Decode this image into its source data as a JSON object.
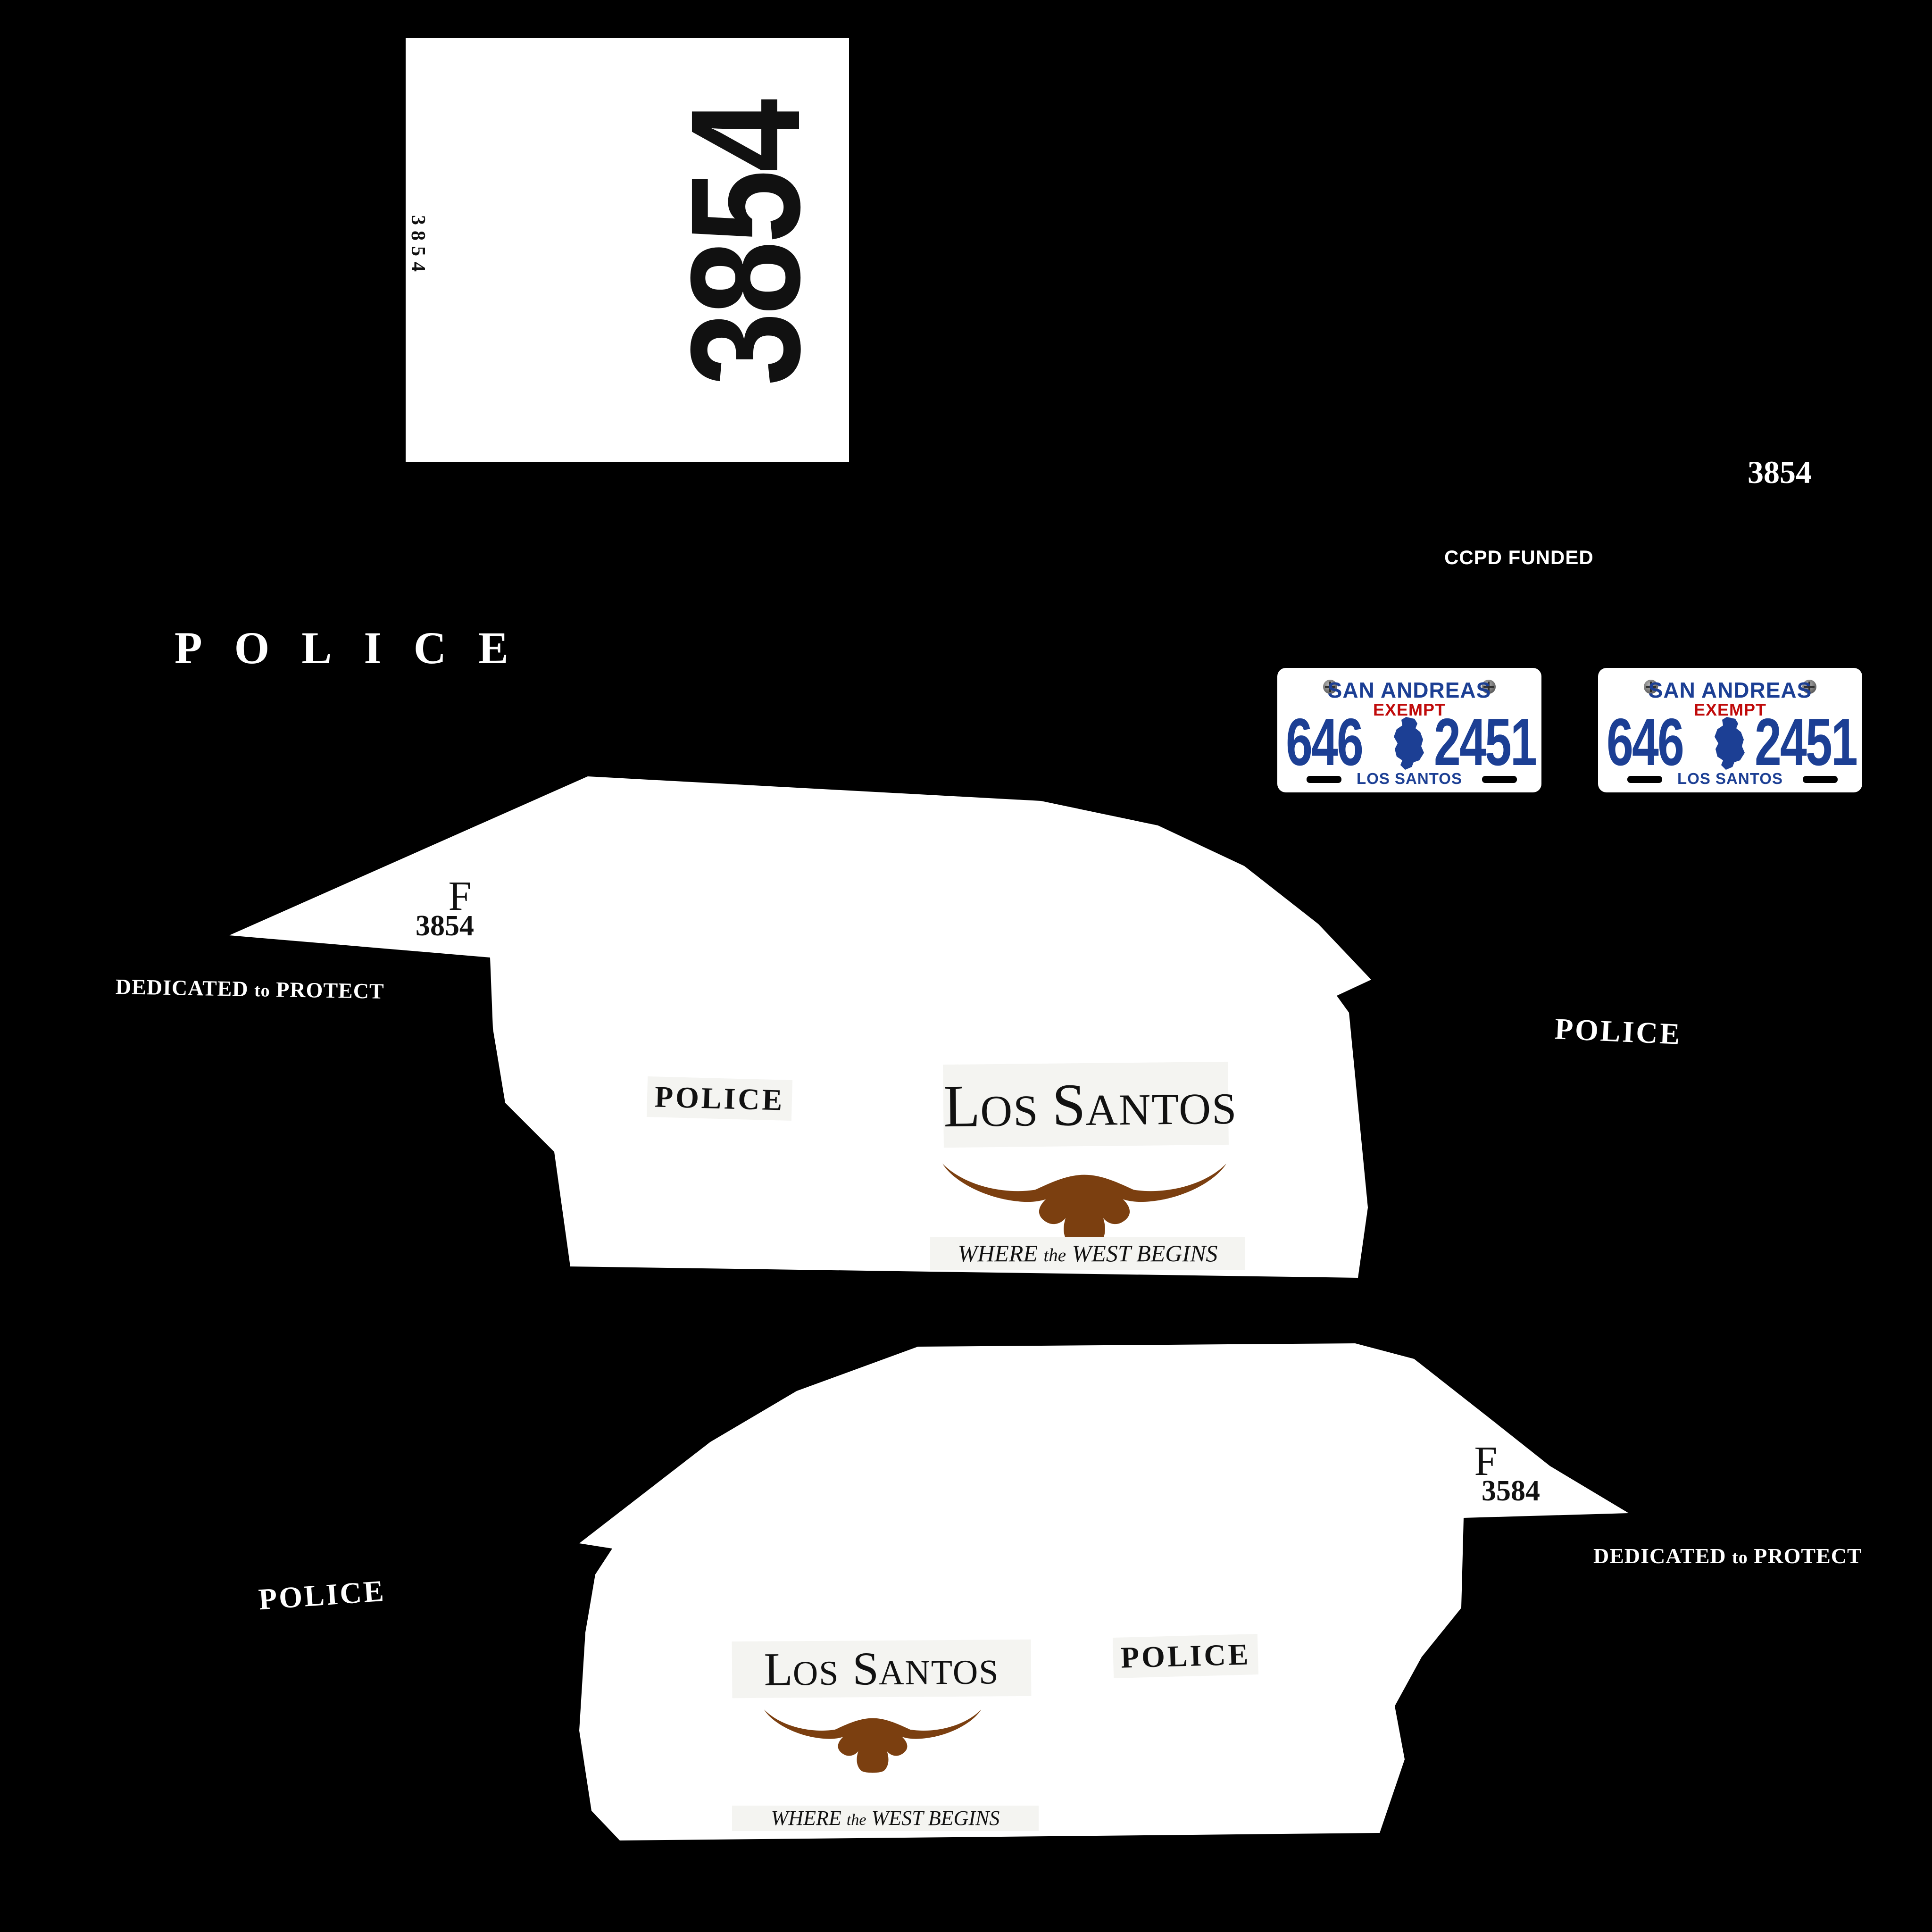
{
  "document": {
    "title": "Los Santos Police vehicle livery texture sheet"
  },
  "colors": {
    "background": "#000000",
    "panel": "#ffffff",
    "ink": "#111111",
    "plate_navy": "#1c3f94",
    "plate_red": "#c00a0a",
    "longhorn_brown": "#7b3f10",
    "logo_strip": "#f4f4f1"
  },
  "roof_panel": {
    "unit_number_large": "3854",
    "unit_number_small": "3854"
  },
  "stray_marks": {
    "unit_number_white": "3854",
    "ccpd_funded": "CCPD FUNDED",
    "police_spaced": "POLICE"
  },
  "license_plate": {
    "state": "SAN ANDREAS",
    "exempt": "EXEMPT",
    "number_left": "646",
    "number_right": "2451",
    "city": "LOS SANTOS"
  },
  "logo": {
    "name_part1_initial": "L",
    "name_part1_rest": "OS",
    "name_part2_initial": "S",
    "name_part2_rest": "ANTOS",
    "tagline_word1": "WHERE",
    "tagline_the": "the",
    "tagline_rest": "WEST BEGINS"
  },
  "car_side_right": {
    "column_letter": "F",
    "unit_number": "3854",
    "police_door": "POLICE",
    "police_rear_white": "POLICE",
    "dedicated_motto": {
      "word1": "DEDICATED",
      "word2": "to",
      "word3": "PROTECT"
    }
  },
  "car_side_left": {
    "column_letter": "F",
    "unit_number": "3584",
    "police_door": "POLICE",
    "police_rear_white": "POLICE",
    "dedicated_motto": {
      "word1": "DEDICATED",
      "word2": "to",
      "word3": "PROTECT"
    }
  }
}
